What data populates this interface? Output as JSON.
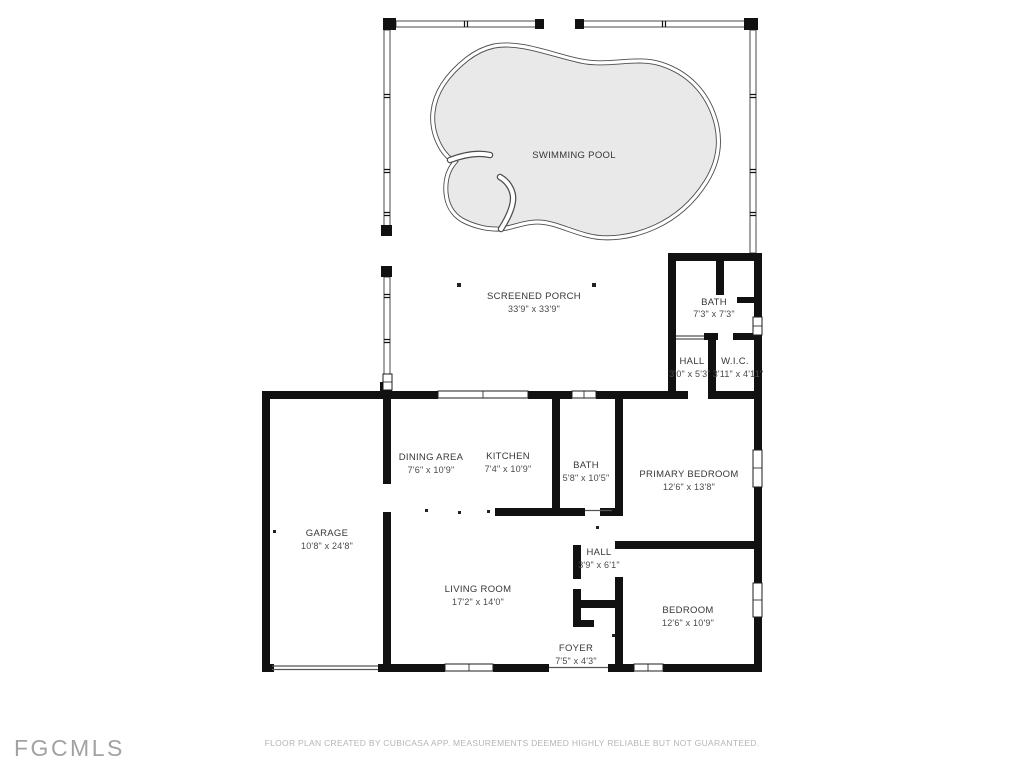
{
  "meta": {
    "type": "floor-plan",
    "creator_note": "FLOOR PLAN CREATED BY CUBICASA APP. MEASUREMENTS DEEMED HIGHLY RELIABLE BUT NOT GUARANTEED.",
    "watermark": "FGCMLS"
  },
  "colors": {
    "wall": "#111111",
    "pool_fill": "#e9e9e9",
    "pool_stroke": "#4d4d4d",
    "room_label": "#373737",
    "watermark": "#a2a2a2",
    "disclaimer": "#b5b5b5",
    "background": "#ffffff"
  },
  "rooms": [
    {
      "id": "swimming-pool",
      "name": "SWIMMING POOL",
      "dims": ""
    },
    {
      "id": "screened-porch",
      "name": "SCREENED PORCH",
      "dims": "33'9\" x 33'9\""
    },
    {
      "id": "bath-upper",
      "name": "BATH",
      "dims": "7'3\" x 7'3\""
    },
    {
      "id": "hall-upper",
      "name": "HALL",
      "dims": "3'0\" x 5'3\""
    },
    {
      "id": "wic",
      "name": "W.I.C.",
      "dims": "3'11\" x 4'11\""
    },
    {
      "id": "dining-area",
      "name": "DINING AREA",
      "dims": "7'6\" x 10'9\""
    },
    {
      "id": "kitchen",
      "name": "KITCHEN",
      "dims": "7'4\" x 10'9\""
    },
    {
      "id": "bath-main",
      "name": "BATH",
      "dims": "5'8\" x 10'5\""
    },
    {
      "id": "primary-bedroom",
      "name": "PRIMARY BEDROOM",
      "dims": "12'6\" x 13'8\""
    },
    {
      "id": "garage",
      "name": "GARAGE",
      "dims": "10'8\" x 24'8\""
    },
    {
      "id": "hall-main",
      "name": "HALL",
      "dims": "3'9\" x 6'1\""
    },
    {
      "id": "living-room",
      "name": "LIVING ROOM",
      "dims": "17'2\" x 14'0\""
    },
    {
      "id": "bedroom",
      "name": "BEDROOM",
      "dims": "12'6\" x 10'9\""
    },
    {
      "id": "foyer",
      "name": "FOYER",
      "dims": "7'5\" x 4'3\""
    }
  ]
}
